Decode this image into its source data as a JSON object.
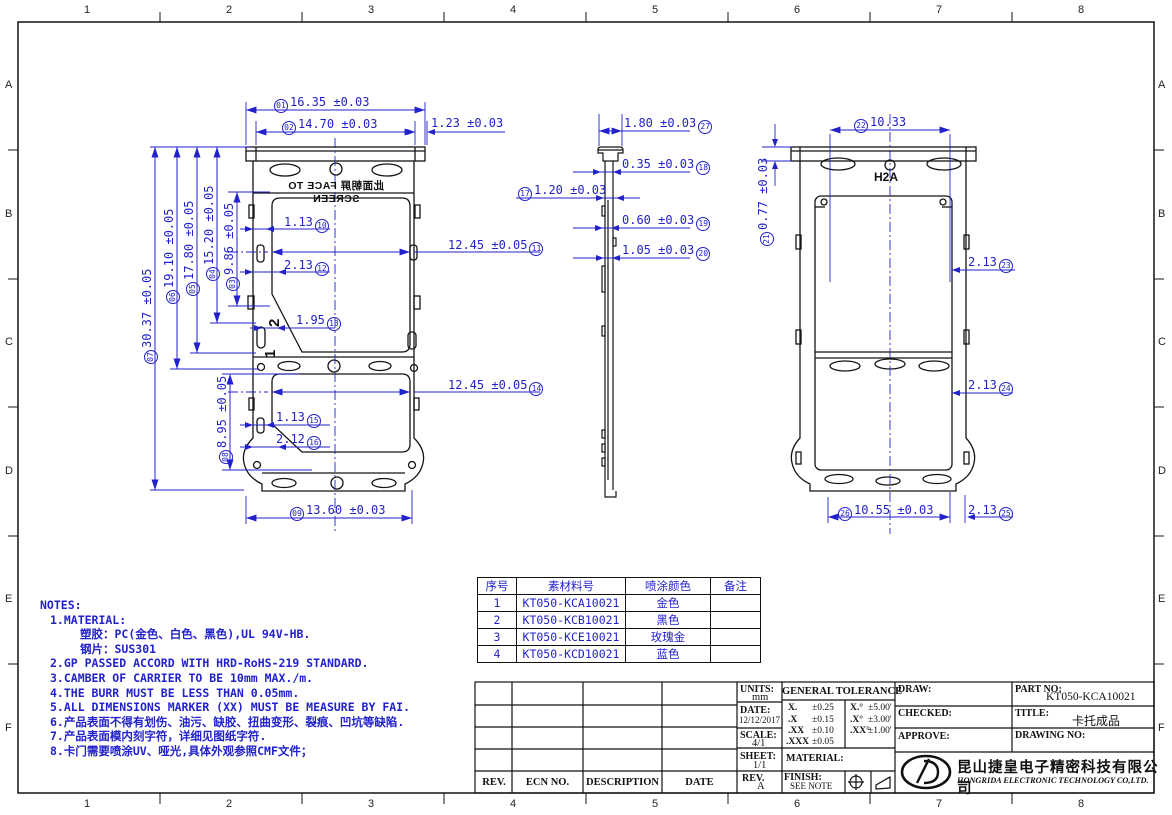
{
  "sheet": {
    "grid_cols": [
      "1",
      "2",
      "3",
      "4",
      "5",
      "6",
      "7",
      "8"
    ],
    "grid_rows": [
      "A",
      "B",
      "C",
      "D",
      "E",
      "F"
    ],
    "dim_color": "#2222cc",
    "line_color": "#141414"
  },
  "views": {
    "front": {
      "face_label_cn": "此面朝屏",
      "face_label_en": "FACE TO SCREEN",
      "digit_upper": "2",
      "digit_lower": "1"
    },
    "rear": {
      "marking": "H2A"
    }
  },
  "dims": {
    "d01": {
      "id": "01",
      "text": "16.35 ±0.03"
    },
    "d02": {
      "id": "02",
      "text": "14.70 ±0.03"
    },
    "dgap": {
      "text": "1.23 ±0.03"
    },
    "d03": {
      "id": "03",
      "text": "9.86 ±0.05"
    },
    "d04": {
      "id": "04",
      "text": "15.20 ±0.05"
    },
    "d05": {
      "id": "05",
      "text": "17.80 ±0.05"
    },
    "d06": {
      "id": "06",
      "text": "19.10 ±0.05"
    },
    "d07": {
      "id": "07",
      "text": "30.37 ±0.05"
    },
    "d08": {
      "id": "08",
      "text": "8.95 ±0.05"
    },
    "d09": {
      "id": "09",
      "text": "13.60 ±0.03"
    },
    "d10": {
      "id": "10",
      "text": "1.13"
    },
    "d11": {
      "id": "11",
      "text": "12.45 ±0.05"
    },
    "d12": {
      "id": "12",
      "text": "2.13"
    },
    "d13": {
      "id": "13",
      "text": "1.95"
    },
    "d14": {
      "id": "14",
      "text": "12.45 ±0.05"
    },
    "d15": {
      "id": "15",
      "text": "1.13"
    },
    "d16": {
      "id": "16",
      "text": "2.12"
    },
    "d17": {
      "id": "17",
      "text": "1.20 ±0.03"
    },
    "d18": {
      "id": "18",
      "text": "0.35 ±0.03"
    },
    "d19": {
      "id": "19",
      "text": "0.60 ±0.03"
    },
    "d20": {
      "id": "20",
      "text": "1.05 ±0.03"
    },
    "d21": {
      "id": "21",
      "text": "0.77 ±0.03"
    },
    "d22": {
      "id": "22",
      "text": "10.33"
    },
    "d23": {
      "id": "23",
      "text": "2.13"
    },
    "d24": {
      "id": "24",
      "text": "2.13"
    },
    "d25": {
      "id": "25",
      "text": "2.13"
    },
    "d26": {
      "id": "26",
      "text": "10.55 ±0.03"
    },
    "d27": {
      "id": "27",
      "text": "1.80 ±0.03"
    }
  },
  "notes": {
    "lines": [
      "NOTES:",
      "1.MATERIAL:",
      "塑胶：PC(金色、白色、黑色),UL 94V-HB.",
      "钢片：SUS301",
      "2.GP PASSED ACCORD WITH HRD-RoHS-219 STANDARD.",
      "3.CAMBER OF CARRIER TO BE 10mm MAX./m.",
      "4.THE BURR MUST BE LESS THAN 0.05mm.",
      "5.ALL DIMENSIONS MARKER (XX) MUST BE MEASURE BY FAI.",
      "6.产品表面不得有划伤、油污、缺胶、扭曲变形、裂痕、凹坑等缺陷.",
      "7.产品表面模内刻字符，详细见图纸字符.",
      "8.卡门需要喷涂UV、哑光,具体外观参照CMF文件；"
    ]
  },
  "material_table": {
    "headers": [
      "序号",
      "素材料号",
      "喷涂颜色",
      "备注"
    ],
    "rows": [
      [
        "1",
        "KT050-KCA10021",
        "金色",
        ""
      ],
      [
        "2",
        "KT050-KCB10021",
        "黑色",
        ""
      ],
      [
        "3",
        "KT050-KCE10021",
        "玫瑰金",
        ""
      ],
      [
        "4",
        "KT050-KCD10021",
        "蓝色",
        ""
      ]
    ]
  },
  "title_block": {
    "revision": {
      "headers": [
        "REV.",
        "ECN NO.",
        "DESCRIPTION",
        "DATE"
      ]
    },
    "units_label": "UNITS:",
    "units_value": "mm",
    "date_label": "DATE:",
    "date_value": "12/12/2017",
    "scale_label": "SCALE:",
    "scale_value": "4/1",
    "sheet_label": "SHEET:",
    "sheet_value": "1/1",
    "rev_label": "REV.",
    "rev_value": "A",
    "tolerance": {
      "title": "GENERAL TOLERANCE",
      "rows": [
        {
          "a": "X.",
          "b": "±0.25",
          "c": "X.°",
          "d": "±5.00'"
        },
        {
          "a": ".X",
          "b": "±0.15",
          "c": ".X°",
          "d": "±3.00'"
        },
        {
          "a": ".XX",
          "b": "±0.10",
          "c": ".XX°",
          "d": "±1.00'"
        },
        {
          "a": ".XXX",
          "b": "±0.05",
          "c": "",
          "d": ""
        }
      ]
    },
    "material_label": "MATERIAL:",
    "finish_label": "FINISH:",
    "finish_value": "SEE NOTE",
    "draw_label": "DRAW:",
    "checked_label": "CHECKED:",
    "approve_label": "APPROVE:",
    "partno_label": "PART NO:",
    "partno_value": "KT050-KCA10021",
    "title_label": "TITLE:",
    "title_value": "卡托成品",
    "drawingno_label": "DRAWING NO:",
    "company_cn": "昆山捷皇电子精密科技有限公司",
    "company_en": "HONGRIDA ELECTRONIC TECHNOLOGY CO,LTD.",
    "logo_text": "VD"
  }
}
